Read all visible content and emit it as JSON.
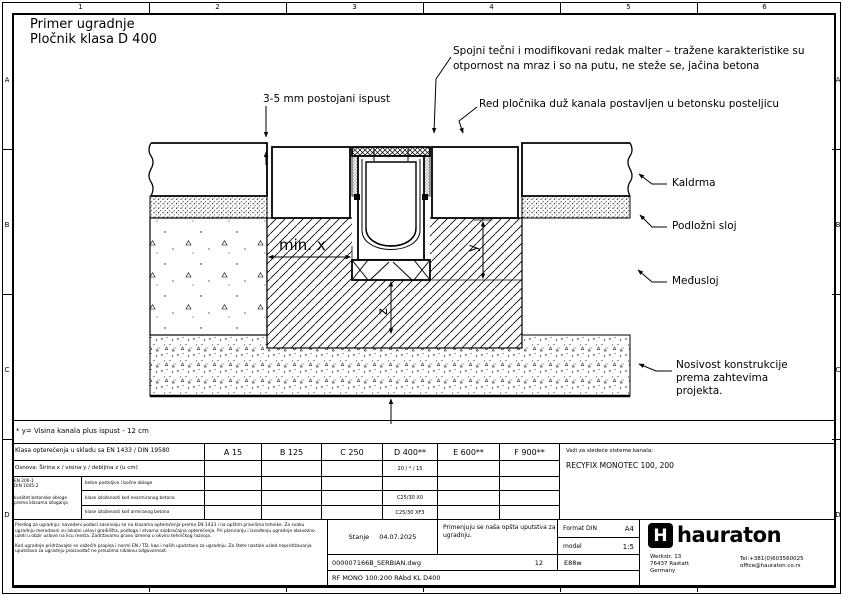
{
  "frame": {
    "columns": [
      "1",
      "2",
      "3",
      "4",
      "5",
      "6"
    ],
    "rows": [
      "A",
      "B",
      "C",
      "D"
    ]
  },
  "title": {
    "line1": "Primer ugradnje",
    "line2": "Pločnik klasa D 400"
  },
  "annotations": {
    "mortar_line1": "Spojni tečni i modifikovani redak malter – tražene karakteristike su",
    "mortar_line2": "otpornost na mraz i so na putu, ne steže se, jačina betona",
    "protrusion": "3-5 mm postojani ispust",
    "paver_row": "Red pločnika duž kanala postavljen u betonsku posteljicu",
    "kaldrma": "Kaldrma",
    "bedding": "Podložni sloj",
    "interlayer": "Međusloj",
    "bearing_lines": [
      "Nosivost konstrukcije",
      "prema zahtevima",
      "projekta."
    ]
  },
  "dimensions": {
    "min_x": "min. x",
    "y": "y",
    "z": "z"
  },
  "footnote": "* y= Visina kanala plus ispust - 12 cm",
  "table": {
    "load_class_label": "Klasa opterećenja u skladu sa EN 1433 / DIN 19580",
    "classes": [
      "A 15",
      "B 125",
      "C 250",
      "D 400**",
      "E 600**",
      "F 900**"
    ],
    "base_label": "Osnova: Širina x / visina y / debljina z (u cm)",
    "base_value_d400": "20 / * / 15",
    "norms": {
      "line1": "EN 206-1",
      "line2": "DIN 1045-2",
      "desc1": "kvalitet betonske obloge",
      "desc2": "prema klasama izlaganja"
    },
    "rows": [
      {
        "label": "beton posteljice i bočne obloge",
        "value_d400": ""
      },
      {
        "label": "klase izloženosti kod nearmiranog betona",
        "value_d400": "C25/30 X0"
      },
      {
        "label": "klase izloženosti kod armiranog betona",
        "value_d400": "C25/30 XF3"
      }
    ],
    "systems_label": "Važi za sledeće sisteme kanala:",
    "systems_value": "RECYFIX MONOTEC 100, 200"
  },
  "titleblock": {
    "disclaimer1": "Predlog za ugradnju: navedeni podaci zasnivaju se na klasama opterećenja prema EN 1433 i na opštim pravilima tehnike. Za svaku ugradnju merodavni su lokalni uslovi gradilišta, podloga i stvarna saobraćajna opterećenja. Pri planiranju i izvođenju ugradnje obavezno uzeti u obzir uslove na licu mesta. Zadržavamo pravo izmena u okviru tehničkog razvoja.",
    "disclaimer2": "Kod ugradnje pridržavajte se važećih propisa i normi EN / TD, kao i naših uputstava za ugradnju. Za štete nastale usled nepridržavanja uputstava za ugradnju proizvođač ne preuzima nikakvu odgovornost.",
    "status_label": "Stanje",
    "status_date": "04.07.2025",
    "note": "Primenjuju se naša opšta uputstva za ugradnju.",
    "format_label": "Format DIN",
    "format_value": "A4",
    "scale_label": "model",
    "scale_value": "1:5",
    "file_name": "000007166B_SERBIAN.dwg",
    "sheet": "12",
    "code": "E88w",
    "product": "RF MONO 100:200 RAbd KL D400",
    "brand": "hauraton",
    "brand_mark": "H",
    "address": [
      "Werkstr. 13",
      "76437 Rastatt",
      "Germany"
    ],
    "phone": "Tel:+381(0)603560025",
    "email": "office@hauraton.co.rs"
  }
}
